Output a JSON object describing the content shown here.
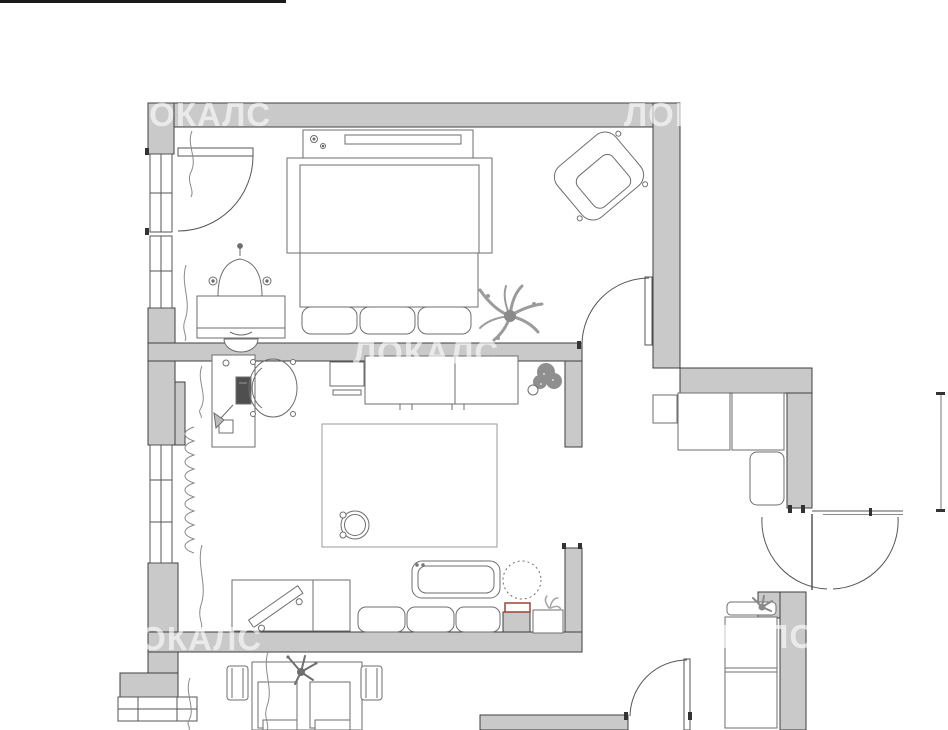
{
  "title": "apartment-floor-plan",
  "watermark": {
    "text": "ЛОКАЛС"
  },
  "colors": {
    "background": "#ffffff",
    "wall_fill": "#c9c9c9",
    "wall_outline": "#3f3f3f",
    "furniture_line": "#6e6e6e",
    "thin_line": "#8a8a8a",
    "plant_gray": "#9a9a9a",
    "plant_dark": "#6f6f6f",
    "laptop_fill": "#4f4f4f",
    "accent_red": "#9b4436",
    "top_bar": "#1a1a1a",
    "watermark": "rgba(255,255,255,0.62)"
  },
  "rooms": [
    {
      "name": "bedroom"
    },
    {
      "name": "living-room"
    },
    {
      "name": "hallway"
    },
    {
      "name": "kitchen"
    },
    {
      "name": "bathroom"
    },
    {
      "name": "entry"
    }
  ],
  "furniture": [
    "double-bed",
    "headboard-shelf",
    "bedroom-bench-sofa",
    "armchair",
    "dressing-table",
    "vanity-mirror",
    "vanity-stool",
    "palm-plant",
    "balcony-door",
    "windows",
    "radiator",
    "curtains",
    "desk",
    "desk-chair",
    "laptop",
    "desk-lamp",
    "wall-shelf",
    "sideboard",
    "potted-plant",
    "area-rug",
    "coffee-table",
    "tv-stand",
    "tv",
    "chaise-sofa",
    "sofa-cushions",
    "pouf",
    "red-tray",
    "side-table",
    "wardrobe-units",
    "rounded-cabinet",
    "entry-double-door",
    "bathroom-cabinets",
    "bathroom-shelf-plant",
    "dining-table",
    "dining-chairs",
    "placemats",
    "table-plant",
    "kitchen-door"
  ]
}
